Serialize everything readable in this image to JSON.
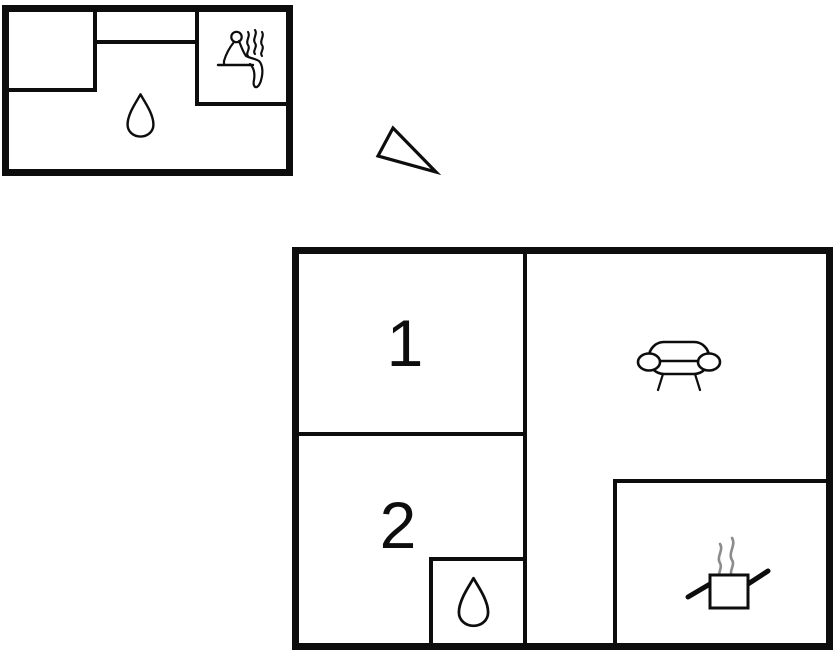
{
  "plan": {
    "colors": {
      "wall": "#0d0d0d",
      "background": "#ffffff",
      "water_fill": "#bdf3f5",
      "steam_gray": "#8c8c8c",
      "text": "#0e0e0e"
    },
    "buildings": {
      "annex": {
        "name": "annex-top-left",
        "icons": [
          "water-drop-icon",
          "sauna-person-icon",
          "steam-icon"
        ]
      },
      "main": {
        "name": "main-bottom-right",
        "rooms": [
          {
            "label": "1"
          },
          {
            "label": "2"
          }
        ],
        "icons": [
          "sofa-icon",
          "cooking-pot-icon",
          "steam-icon",
          "water-drop-icon"
        ]
      }
    },
    "compass": {
      "icon": "north-arrow-icon"
    }
  }
}
